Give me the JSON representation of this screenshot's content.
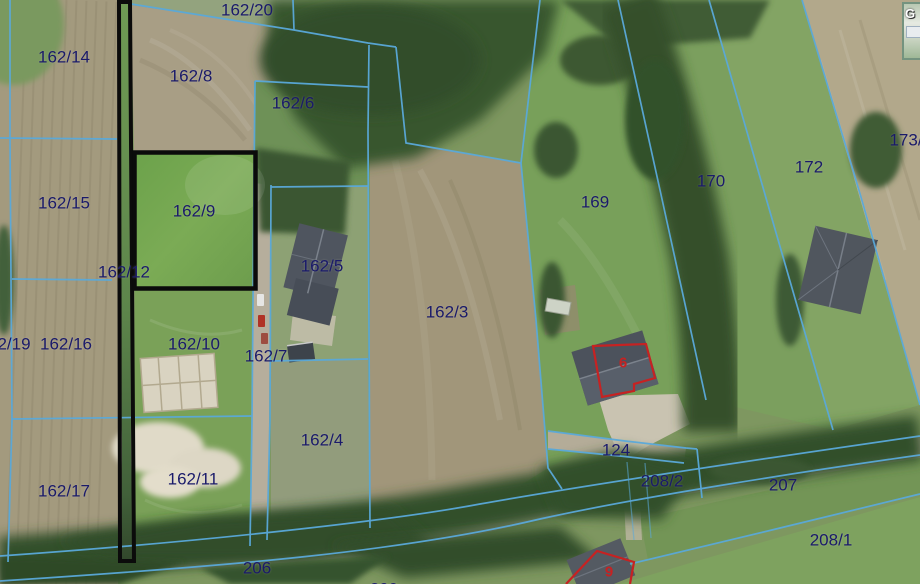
{
  "map": {
    "view": "aerial-cadastral",
    "colors": {
      "boundary_line": "#5aa9da",
      "highlight_outline": "#0b0b0b",
      "selection_outline_red": "#c62222",
      "parcel_label": "#1a1a6a",
      "building_label": "#c62222"
    },
    "highlighted_parcels": [
      "162/12",
      "162/9"
    ],
    "inset_watermark": "G",
    "parcel_labels": [
      {
        "text": "162/14",
        "x": 64,
        "y": 57
      },
      {
        "text": "162/20",
        "x": 247,
        "y": 10
      },
      {
        "text": "162/8",
        "x": 191,
        "y": 76
      },
      {
        "text": "162/6",
        "x": 293,
        "y": 103
      },
      {
        "text": "173/",
        "x": 906,
        "y": 140
      },
      {
        "text": "172",
        "x": 809,
        "y": 167
      },
      {
        "text": "170",
        "x": 711,
        "y": 181
      },
      {
        "text": "169",
        "x": 595,
        "y": 202
      },
      {
        "text": "162/15",
        "x": 64,
        "y": 203
      },
      {
        "text": "162/9",
        "x": 194,
        "y": 211
      },
      {
        "text": "162/12",
        "x": 124,
        "y": 272
      },
      {
        "text": "162/5",
        "x": 322,
        "y": 266
      },
      {
        "text": "162/3",
        "x": 447,
        "y": 312
      },
      {
        "text": "2/19",
        "x": 14,
        "y": 344
      },
      {
        "text": "162/16",
        "x": 66,
        "y": 344
      },
      {
        "text": "162/10",
        "x": 194,
        "y": 344
      },
      {
        "text": "162/7",
        "x": 266,
        "y": 356
      },
      {
        "text": "162/4",
        "x": 322,
        "y": 440
      },
      {
        "text": "162/11",
        "x": 193,
        "y": 479
      },
      {
        "text": "162/17",
        "x": 64,
        "y": 491
      },
      {
        "text": "124",
        "x": 616,
        "y": 450
      },
      {
        "text": "208/2",
        "x": 662,
        "y": 481
      },
      {
        "text": "207",
        "x": 783,
        "y": 485
      },
      {
        "text": "208/1",
        "x": 831,
        "y": 540
      },
      {
        "text": "206",
        "x": 257,
        "y": 568
      },
      {
        "text": "209",
        "x": 384,
        "y": 589
      }
    ],
    "building_labels": [
      {
        "text": "6",
        "x": 623,
        "y": 363
      },
      {
        "text": "9",
        "x": 609,
        "y": 572
      }
    ]
  }
}
